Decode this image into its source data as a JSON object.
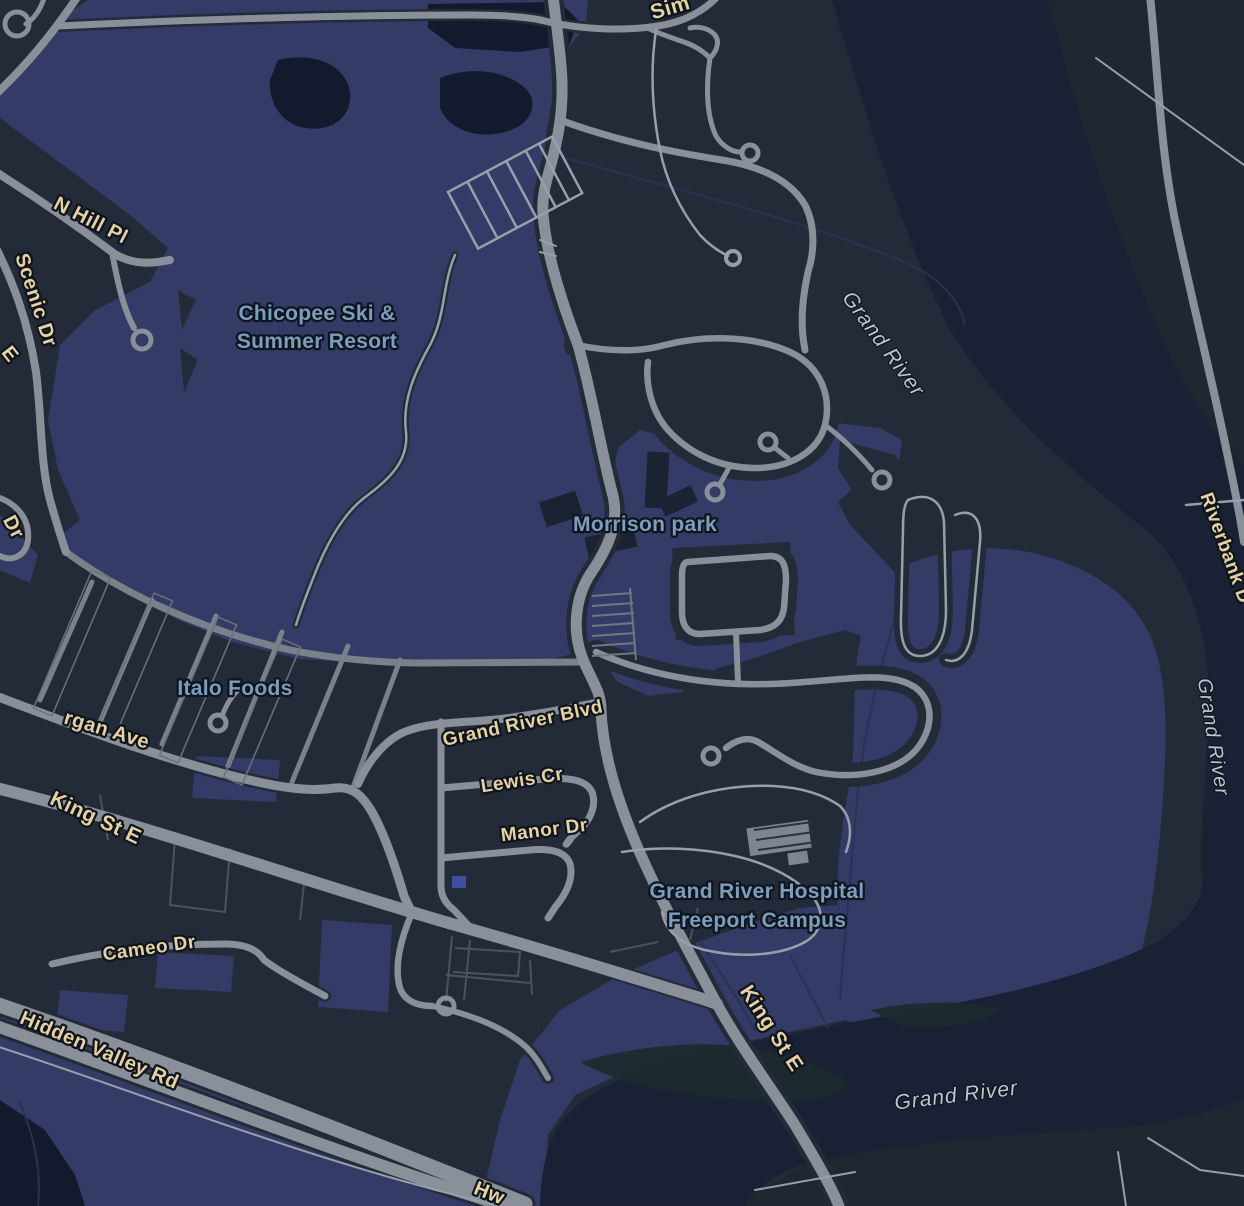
{
  "map": {
    "colors": {
      "land": "#232b38",
      "land_dark": "#202730",
      "water": "#1a2134",
      "park": "#343b66",
      "park_bright": "#3d4f9e",
      "pond": "#131a2e",
      "wetland": "#1d2a2e",
      "stream": "#2a3154",
      "road": "#8a9099",
      "road_minor": "#79818b",
      "road_thin": "#4a5360",
      "path": "#97a0aa",
      "building": "#1b2232",
      "structure": "#7e858f",
      "label_road": "#e6d1a1",
      "label_poi": "#7d9dbc",
      "label_water": "#bfc5cf",
      "halo": "#0f151f"
    },
    "labels": {
      "roads": {
        "sim": "Sim",
        "n_hill_pl": "N Hill Pl",
        "scenic_dr": "Scenic Dr",
        "frag_e": "E",
        "frag_dr": "Dr",
        "rgan_ave": "rgan Ave",
        "grand_river_blvd": "Grand River Blvd",
        "lewis_cr": "Lewis Cr",
        "manor_dr": "Manor Dr",
        "king_st_e_west": "King St E",
        "cameo_dr": "Cameo Dr",
        "hidden_valley_rd": "Hidden Valley Rd",
        "hwy_fragment": "Hw",
        "king_st_e_bridge": "King St E",
        "riverbank_dr": "Riverbank D"
      },
      "pois": {
        "chicopee_line1": "Chicopee Ski &",
        "chicopee_line2": "Summer Resort",
        "morrison_park": "Morrison park",
        "italo_foods": "Italo Foods",
        "hospital_line1": "Grand River Hospital",
        "hospital_line2": "Freeport Campus"
      },
      "water": {
        "grand_river_upper": "Grand River",
        "grand_river_east": "Grand River",
        "grand_river_south": "Grand River"
      }
    }
  }
}
